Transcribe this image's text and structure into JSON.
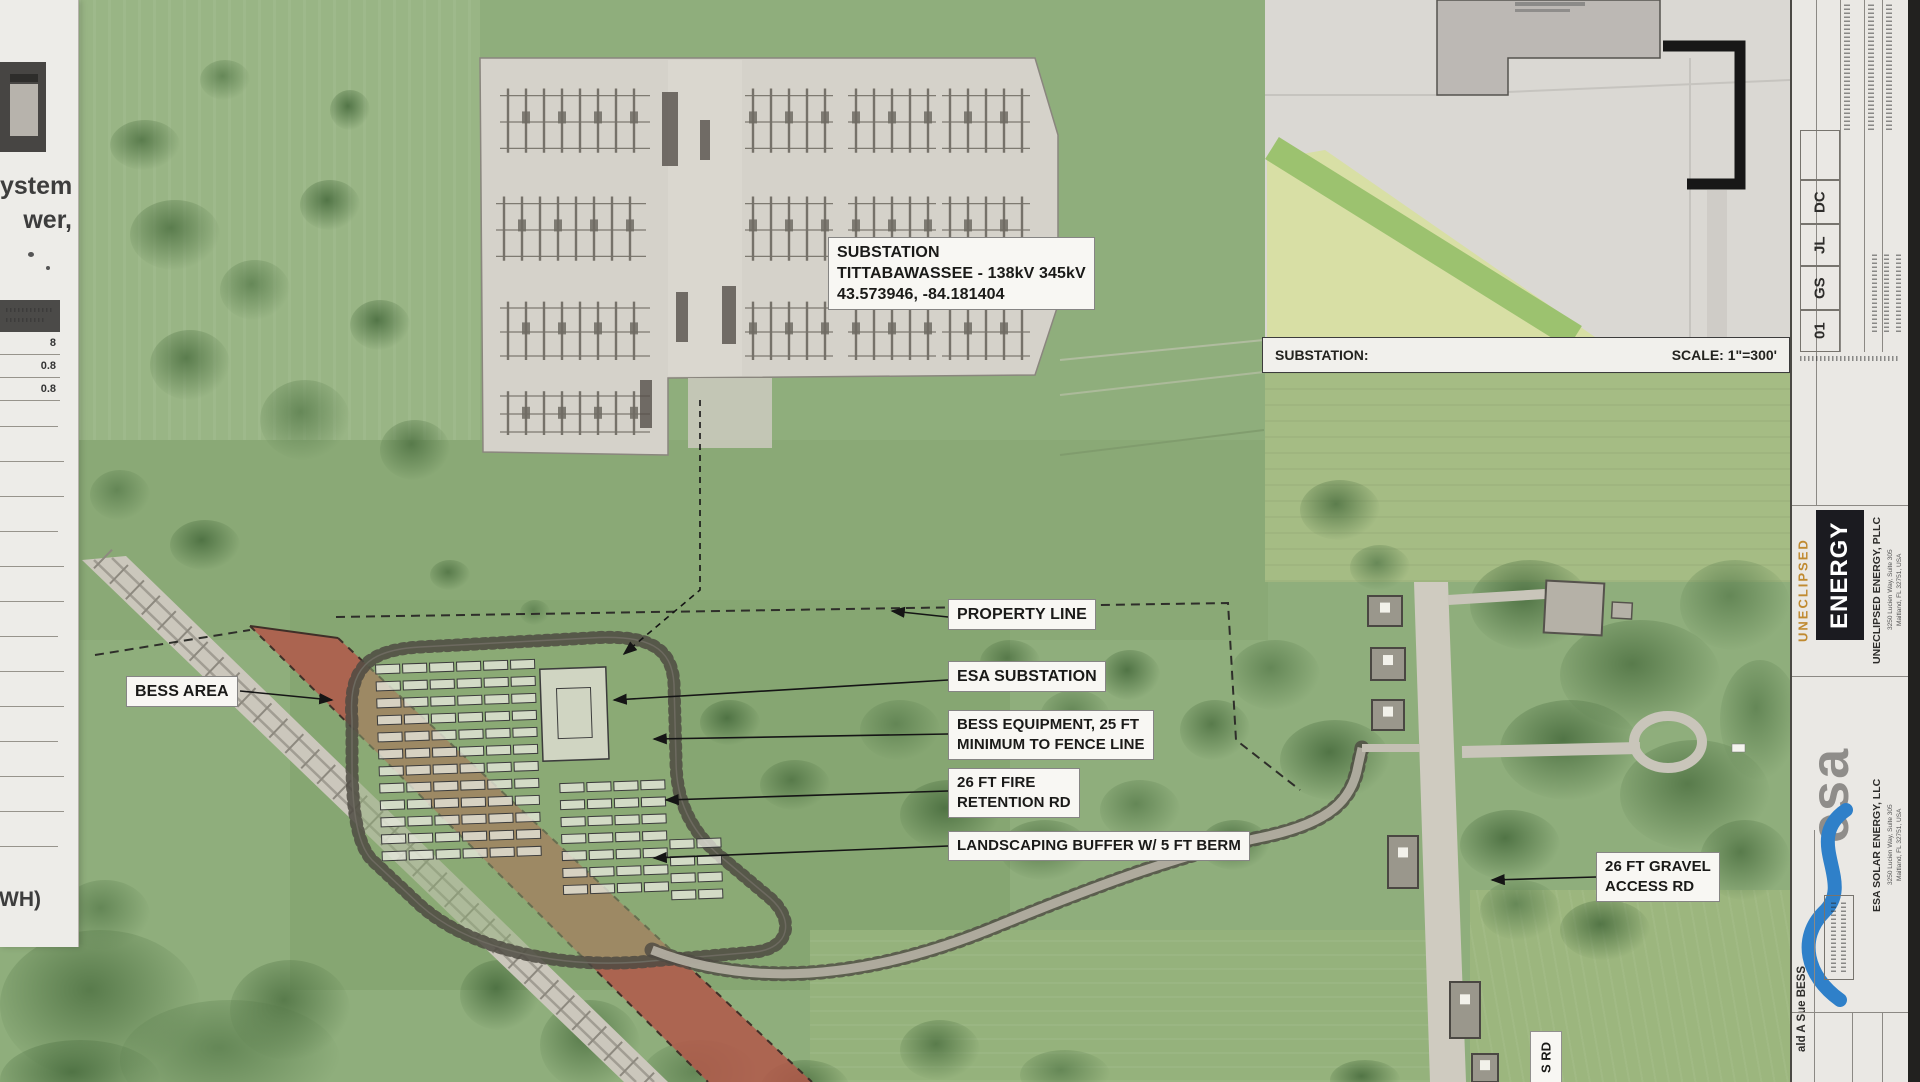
{
  "map_labels": {
    "substation_callout": {
      "line1": "SUBSTATION",
      "line2": "TITTABAWASSEE - 138kV 345kV",
      "line3": "43.573946, -84.181404"
    },
    "property_line": "PROPERTY LINE",
    "esa_substation": "ESA SUBSTATION",
    "bess_equipment_line1": "BESS EQUIPMENT, 25 FT",
    "bess_equipment_line2": "MINIMUM TO FENCE LINE",
    "fire_line1": "26 FT FIRE",
    "fire_line2": "RETENTION RD",
    "landscaping": "LANDSCAPING BUFFER W/ 5 FT BERM",
    "bess_area": "BESS AREA",
    "gravel_line1": "26 FT GRAVEL",
    "gravel_line2": "ACCESS RD",
    "road_name_fragment": "S RD"
  },
  "inset": {
    "title": "SUBSTATION:",
    "scale": "SCALE: 1\"=300'"
  },
  "left_panel": {
    "fragment_top": "ystem",
    "fragment_2": "wer,",
    "table_values": [
      "8",
      "0.8",
      "0.8"
    ],
    "fragment_bottom": "(WH)"
  },
  "title_block": {
    "revision_cells": [
      "DC",
      "JL",
      "GS",
      "01"
    ],
    "uneclipsed_logo_word1": "UNECLIPSED",
    "uneclipsed_logo_word2": "ENERGY",
    "uneclipsed_company": "UNECLIPSED ENERGY, PLLC",
    "uneclipsed_address1": "3250 Lucien Way, Suite 305",
    "uneclipsed_address2": "Maitland, FL 32751, USA",
    "esa_logo": "esa",
    "esa_company": "ESA SOLAR ENERGY, LLC",
    "esa_address1": "3250 Lucien Way, Suite 305",
    "esa_address2": "Maitland, FL 32751, USA",
    "project_fragment": "ald A Sue BESS"
  },
  "colors": {
    "aerial_green": "#8fae7c",
    "red_corridor": "#b2584a",
    "label_bg": "#f8f7f3",
    "uneclipsed_gold": "#c08a30",
    "esa_blue": "#2f80c9"
  }
}
